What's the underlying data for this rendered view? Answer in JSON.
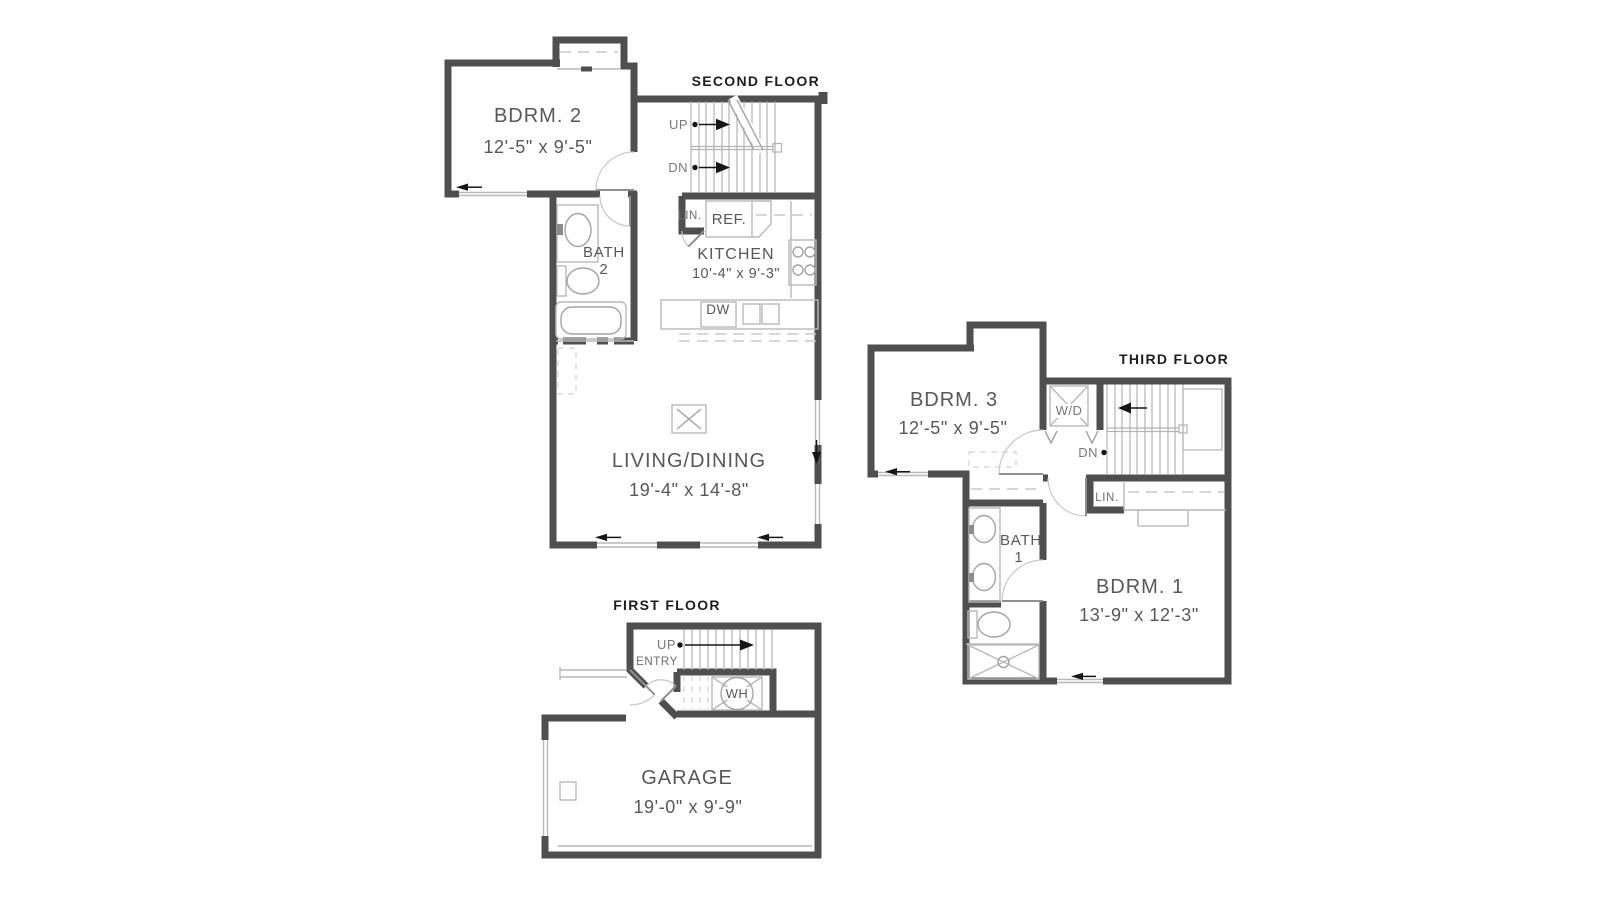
{
  "document_type": "residential floor plan, 3 levels",
  "colors": {
    "background": "#ffffff",
    "wall": "#4f4f4f",
    "fixture_line": "#b9b9b9",
    "stair_line": "#b3b3b3",
    "label_text": "#57585a",
    "title_text": "#1e1e1e",
    "arrow_black": "#161616"
  },
  "floors": {
    "second": {
      "title": "SECOND FLOOR",
      "bdrm2_name": "BDRM. 2",
      "bdrm2_dims": "12'-5\" x 9'-5\"",
      "bath_line1": "BATH",
      "bath_line2": "2",
      "kitchen_name": "KITCHEN",
      "kitchen_dims": "10'-4\" x 9'-3\"",
      "living_name": "LIVING/DINING",
      "living_dims": "19'-4\" x 14'-8\"",
      "up": "UP",
      "dn": "DN",
      "lin": "LIN.",
      "ref": "REF.",
      "dw": "DW"
    },
    "third": {
      "title": "THIRD FLOOR",
      "bdrm3_name": "BDRM. 3",
      "bdrm3_dims": "12'-5\" x 9'-5\"",
      "bdrm1_name": "BDRM. 1",
      "bdrm1_dims": "13'-9\" x 12'-3\"",
      "bath_line1": "BATH",
      "bath_line2": "1",
      "wd": "W/D",
      "dn": "DN",
      "lin": "LIN."
    },
    "first": {
      "title": "FIRST FLOOR",
      "garage_name": "GARAGE",
      "garage_dims": "19'-0\" x 9'-9\"",
      "up": "UP",
      "entry": "ENTRY",
      "wh": "WH"
    }
  }
}
